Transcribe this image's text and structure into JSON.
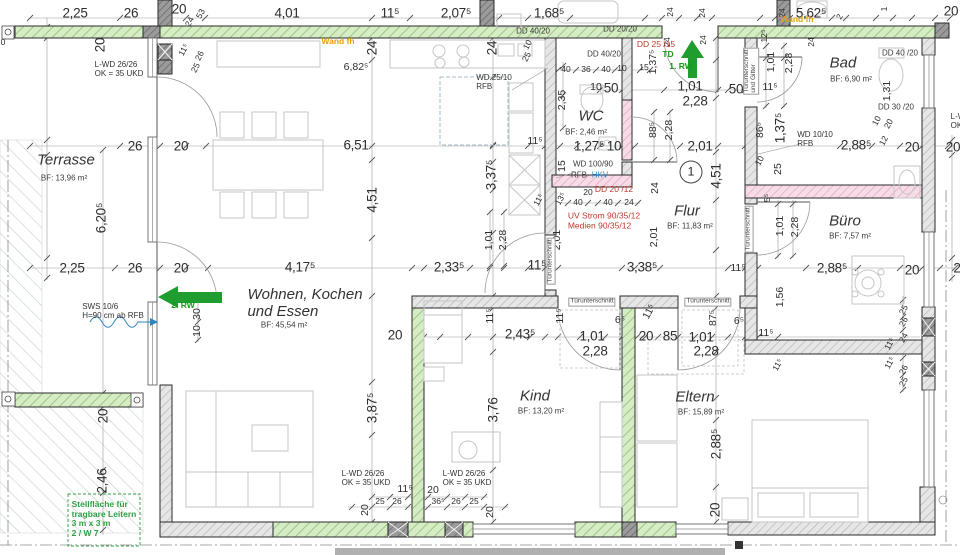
{
  "colors": {
    "wall_green": "#d6ecc4",
    "wall_green_hatch": "#8fbe77",
    "wall_grey": "#e6e6e6",
    "wall_pink": "#f7dce8",
    "accent_green": "#1f9d2f",
    "dim_red": "#c0392b",
    "note_orange": "#e3a008",
    "note_blue": "#2e86c1"
  },
  "rooms": [
    {
      "name": "Terrasse",
      "area": "BF: 13,96 m²",
      "nx": 66,
      "ny": 161,
      "ax": 64,
      "ay": 179
    },
    {
      "name": "Wohnen, Kochen\nund Essen",
      "area": "BF: 45,54 m²",
      "nx": 305,
      "ny": 304,
      "ax": 284,
      "ay": 326
    },
    {
      "name": "WC",
      "area": "BF: 2,46 m²",
      "nx": 591,
      "ny": 117,
      "ax": 586,
      "ay": 133
    },
    {
      "name": "Flur",
      "area": "BF: 11,83 m²",
      "nx": 687,
      "ny": 212,
      "ax": 690,
      "ay": 227
    },
    {
      "name": "Bad",
      "area": "BF: 6,90 m²",
      "nx": 843,
      "ny": 64,
      "ax": 851,
      "ay": 80
    },
    {
      "name": "Büro",
      "area": "BF: 7,57 m²",
      "nx": 845,
      "ny": 222,
      "ax": 850,
      "ay": 237
    },
    {
      "name": "Kind",
      "area": "BF: 13,20 m²",
      "nx": 535,
      "ny": 397,
      "ax": 541,
      "ay": 412
    },
    {
      "name": "Eltern",
      "area": "BF: 15,89 m²",
      "nx": 695,
      "ny": 398,
      "ax": 701,
      "ay": 413
    }
  ],
  "marker": {
    "t": "1",
    "x": 691,
    "y": 172
  },
  "dims": [
    [
      "2,25",
      75,
      13,
      "lg"
    ],
    [
      "26",
      131,
      13,
      "lg"
    ],
    [
      "20",
      179,
      9,
      "lg"
    ],
    [
      "4,01",
      287,
      13,
      "lg"
    ],
    [
      "11⁵",
      390,
      13,
      "lg"
    ],
    [
      "2,07⁵",
      456,
      13,
      "lg"
    ],
    [
      "1,68⁵",
      549,
      13,
      "lg"
    ],
    [
      "5,62⁵",
      811,
      13,
      "lg"
    ],
    [
      "20",
      951,
      11,
      "lg"
    ],
    [
      "53",
      201,
      14,
      "sm",
      -62
    ],
    [
      "24",
      190,
      22,
      "sm",
      -62
    ],
    [
      "24",
      671,
      12,
      "sm",
      -90
    ],
    [
      "24",
      703,
      13,
      "sm",
      -90
    ],
    [
      "24",
      783,
      13,
      "sm",
      -90
    ],
    [
      "2",
      840,
      17,
      "sm",
      -62
    ],
    [
      "1",
      885,
      9,
      "sm",
      -90
    ],
    [
      "0",
      3,
      43,
      "sm"
    ],
    [
      "20",
      100,
      45,
      "lg",
      -90
    ],
    [
      "11⁵",
      184,
      50,
      "sm",
      -62
    ],
    [
      "26",
      200,
      56,
      "sm",
      -62
    ],
    [
      "25",
      196,
      68,
      "sm",
      -62
    ],
    [
      "26",
      135,
      146,
      "lg"
    ],
    [
      "20",
      181,
      146,
      "lg"
    ],
    [
      "6,20⁵",
      101,
      218,
      "lg",
      -90
    ],
    [
      "2,25",
      72,
      268,
      "lg"
    ],
    [
      "26",
      135,
      268,
      "lg"
    ],
    [
      "20",
      181,
      268,
      "lg"
    ],
    [
      "20",
      103,
      416,
      "lg",
      -90
    ],
    [
      "2,46",
      102,
      481,
      "lg",
      -90
    ],
    [
      "6,82⁵",
      356,
      68,
      "md"
    ],
    [
      "24",
      372,
      48,
      "lg",
      -90
    ],
    [
      "24",
      492,
      48,
      "lg",
      -90
    ],
    [
      "6,51",
      356,
      145,
      "lg"
    ],
    [
      "4,51",
      372,
      200,
      "lg",
      -90
    ],
    [
      "3,87⁵",
      372,
      408,
      "lg",
      -90
    ],
    [
      "4,17⁵",
      300,
      267,
      "lg"
    ],
    [
      "10",
      198,
      331,
      "md",
      -90
    ],
    [
      "30",
      198,
      314,
      "md",
      -90
    ],
    [
      "25",
      527,
      57,
      "sm",
      -62
    ],
    [
      "10",
      528,
      45,
      "sm",
      -62
    ],
    [
      "3,37⁵",
      491,
      175,
      "lg",
      -90
    ],
    [
      "11⁵",
      535,
      142,
      "md"
    ],
    [
      "15",
      563,
      166,
      "md",
      -90
    ],
    [
      "2,33⁵",
      449,
      267,
      "lg"
    ],
    [
      "1,01",
      490,
      240,
      "md",
      -90
    ],
    [
      "2,28",
      504,
      240,
      "md",
      -90
    ],
    [
      "11⁵",
      539,
      200,
      "sm",
      -62
    ],
    [
      "13⁵",
      561,
      199,
      "sm",
      -62
    ],
    [
      "40",
      566,
      70,
      "sm"
    ],
    [
      "36",
      586,
      70,
      "sm"
    ],
    [
      "40",
      606,
      70,
      "sm"
    ],
    [
      "10",
      622,
      69,
      "sm"
    ],
    [
      "15",
      644,
      68,
      "sm"
    ],
    [
      "1,37⁵",
      654,
      62,
      "md",
      -90
    ],
    [
      "10",
      596,
      88,
      "md"
    ],
    [
      "50",
      611,
      88,
      "lg"
    ],
    [
      "1,01",
      690,
      86,
      "lg"
    ],
    [
      "2,28",
      695,
      101,
      "lg"
    ],
    [
      "50",
      736,
      89,
      "lg"
    ],
    [
      "2,35",
      563,
      100,
      "md",
      -90
    ],
    [
      "1,27⁵",
      589,
      146,
      "lg"
    ],
    [
      "10",
      614,
      146,
      "lg"
    ],
    [
      "88⁵",
      654,
      130,
      "md",
      -90
    ],
    [
      "2,28",
      670,
      130,
      "md",
      -90
    ],
    [
      "2,01",
      700,
      146,
      "lg"
    ],
    [
      "20",
      588,
      193,
      "sm"
    ],
    [
      "40",
      578,
      203,
      "sm"
    ],
    [
      "40",
      608,
      203,
      "sm"
    ],
    [
      "24",
      629,
      203,
      "sm"
    ],
    [
      "24",
      656,
      188,
      "md",
      -90
    ],
    [
      "2,01",
      558,
      240,
      "md",
      -90
    ],
    [
      "2,01",
      655,
      237,
      "md",
      -90
    ],
    [
      "4,51",
      716,
      176,
      "lg",
      -90
    ],
    [
      "3,38⁵",
      642,
      267,
      "lg"
    ],
    [
      "11⁵",
      537,
      265,
      "lg"
    ],
    [
      "11⁵",
      738,
      269,
      "md"
    ],
    [
      "12⁵",
      765,
      36,
      "sm",
      -90
    ],
    [
      "24",
      668,
      42,
      "sm",
      -90
    ],
    [
      "24",
      704,
      40,
      "sm",
      -90
    ],
    [
      "24",
      812,
      42,
      "sm",
      -90
    ],
    [
      "1,01",
      772,
      62,
      "md",
      -90
    ],
    [
      "2,28",
      790,
      63,
      "md",
      -90
    ],
    [
      "11⁵",
      770,
      88,
      "md"
    ],
    [
      "86⁵",
      761,
      130,
      "md",
      -90
    ],
    [
      "1,37⁵",
      780,
      128,
      "lg",
      -90
    ],
    [
      "10",
      760,
      161,
      "sm",
      -62
    ],
    [
      "25",
      779,
      169,
      "md",
      -90
    ],
    [
      "2,88⁵",
      856,
      145,
      "lg"
    ],
    [
      "20",
      912,
      147,
      "lg"
    ],
    [
      "20",
      953,
      147,
      "lg"
    ],
    [
      "1,31",
      888,
      91,
      "md",
      -90
    ],
    [
      "10",
      877,
      121,
      "sm",
      -62
    ],
    [
      "20",
      889,
      124,
      "sm",
      -62
    ],
    [
      "12",
      884,
      141,
      "sm",
      -62
    ],
    [
      "5⁵",
      768,
      198,
      "sm",
      -90
    ],
    [
      "1,01",
      781,
      226,
      "md",
      -90
    ],
    [
      "2,28",
      796,
      227,
      "md",
      -90
    ],
    [
      "2,88⁵",
      832,
      268,
      "lg"
    ],
    [
      "20",
      912,
      270,
      "lg"
    ],
    [
      "2",
      957,
      268,
      "lg"
    ],
    [
      "1,56",
      781,
      297,
      "md",
      -90
    ],
    [
      "11⁵",
      766,
      334,
      "md"
    ],
    [
      "25",
      904,
      310,
      "sm",
      -62
    ],
    [
      "26",
      904,
      322,
      "sm",
      -62
    ],
    [
      "24",
      904,
      338,
      "sm",
      -62
    ],
    [
      "11⁵",
      890,
      344,
      "sm",
      -62
    ],
    [
      "11⁵",
      890,
      363,
      "sm",
      -62
    ],
    [
      "26",
      904,
      370,
      "sm",
      -62
    ],
    [
      "25",
      904,
      382,
      "sm",
      -62
    ],
    [
      "2,43⁵",
      520,
      334,
      "lg"
    ],
    [
      "11⁵",
      491,
      316,
      "md",
      -90
    ],
    [
      "11⁵",
      561,
      316,
      "md",
      -90
    ],
    [
      "6⁵",
      620,
      321,
      "md"
    ],
    [
      "1,01",
      592,
      336,
      "lg"
    ],
    [
      "2,28",
      595,
      351,
      "lg"
    ],
    [
      "20",
      395,
      335,
      "lg"
    ],
    [
      "3,76",
      493,
      410,
      "lg",
      -90
    ],
    [
      "11⁵",
      405,
      490,
      "md"
    ],
    [
      "20",
      433,
      491,
      "md"
    ],
    [
      "25",
      380,
      502,
      "sm"
    ],
    [
      "26",
      397,
      502,
      "sm"
    ],
    [
      "36⁵",
      438,
      502,
      "sm"
    ],
    [
      "26",
      456,
      502,
      "sm"
    ],
    [
      "25",
      474,
      502,
      "sm"
    ],
    [
      "20",
      366,
      510,
      "md",
      -90
    ],
    [
      "20",
      491,
      512,
      "md",
      -90
    ],
    [
      "11⁵",
      650,
      312,
      "md",
      -62
    ],
    [
      "20",
      646,
      336,
      "lg"
    ],
    [
      "85",
      670,
      336,
      "lg"
    ],
    [
      "1,01",
      701,
      337,
      "lg"
    ],
    [
      "2,28",
      706,
      351,
      "lg"
    ],
    [
      "87⁵",
      714,
      318,
      "md",
      -90
    ],
    [
      "6⁵",
      739,
      322,
      "md"
    ],
    [
      "11⁵",
      778,
      365,
      "sm",
      -62
    ],
    [
      "2,88⁵",
      716,
      444,
      "lg",
      -90
    ],
    [
      "20",
      715,
      510,
      "lg",
      -90
    ]
  ],
  "annos": [
    [
      "Wand fh",
      338,
      42,
      "orange"
    ],
    [
      "Wand fh",
      797,
      20,
      "orange"
    ],
    [
      "DD 40/20",
      533,
      32,
      "sm2"
    ],
    [
      "DD 20/20",
      620,
      30,
      "sm2"
    ],
    [
      "DD 40/20",
      604,
      55,
      "sm2"
    ],
    [
      "DD 40 /20",
      900,
      54,
      "sm2"
    ],
    [
      "DD 30 /20",
      896,
      108,
      "sm2"
    ],
    [
      "DD 25 /15",
      656,
      45,
      "red"
    ],
    [
      "DD 20 /12",
      614,
      190,
      "red"
    ],
    [
      "UV Strom 90/35/12\nMedien 90/35/12",
      604,
      221,
      "red"
    ],
    [
      "TD",
      668,
      55,
      "green"
    ],
    [
      "1. RW",
      681,
      67,
      "green"
    ],
    [
      "2. RW",
      183,
      306,
      "green"
    ],
    [
      "L-WD 26/26\nOK = 35 UKD",
      119,
      70,
      "note"
    ],
    [
      "L-WD 26/26\nOK = 35 UKD",
      366,
      479,
      "note"
    ],
    [
      "L-WD 26/26\nOK = 35 UKD",
      467,
      479,
      "note"
    ],
    [
      "L-WD 26/26\nOK = 35 UKD",
      975,
      122,
      "note"
    ],
    [
      "SWS 10/6\nH=90 cm ab RFB",
      113,
      312,
      "note"
    ],
    [
      "WD 25/10\nRFB",
      494,
      83,
      "note"
    ],
    [
      "WD 10/10\nRFB",
      815,
      140,
      "note"
    ],
    [
      "WD 100/90",
      593,
      165,
      "sm2"
    ],
    [
      "RFB",
      579,
      176,
      "sm2"
    ],
    [
      "HKV",
      600,
      176,
      "blue"
    ],
    [
      "Türunterschnitt",
      592,
      302,
      "tub"
    ],
    [
      "Türunterschnitt",
      708,
      302,
      "tub"
    ],
    [
      "Türunterschnitt",
      551,
      261,
      "tub",
      -90
    ],
    [
      "Türunterschnitt",
      749,
      229,
      "tub",
      -90
    ],
    [
      "Türunterschnitt\nund Gitter",
      751,
      71,
      "tub",
      -90
    ],
    [
      "Stellfläche für\ntragbare Leitern\n3 m x 3 m\n2 / W 7",
      104,
      519,
      "grnbox"
    ]
  ]
}
